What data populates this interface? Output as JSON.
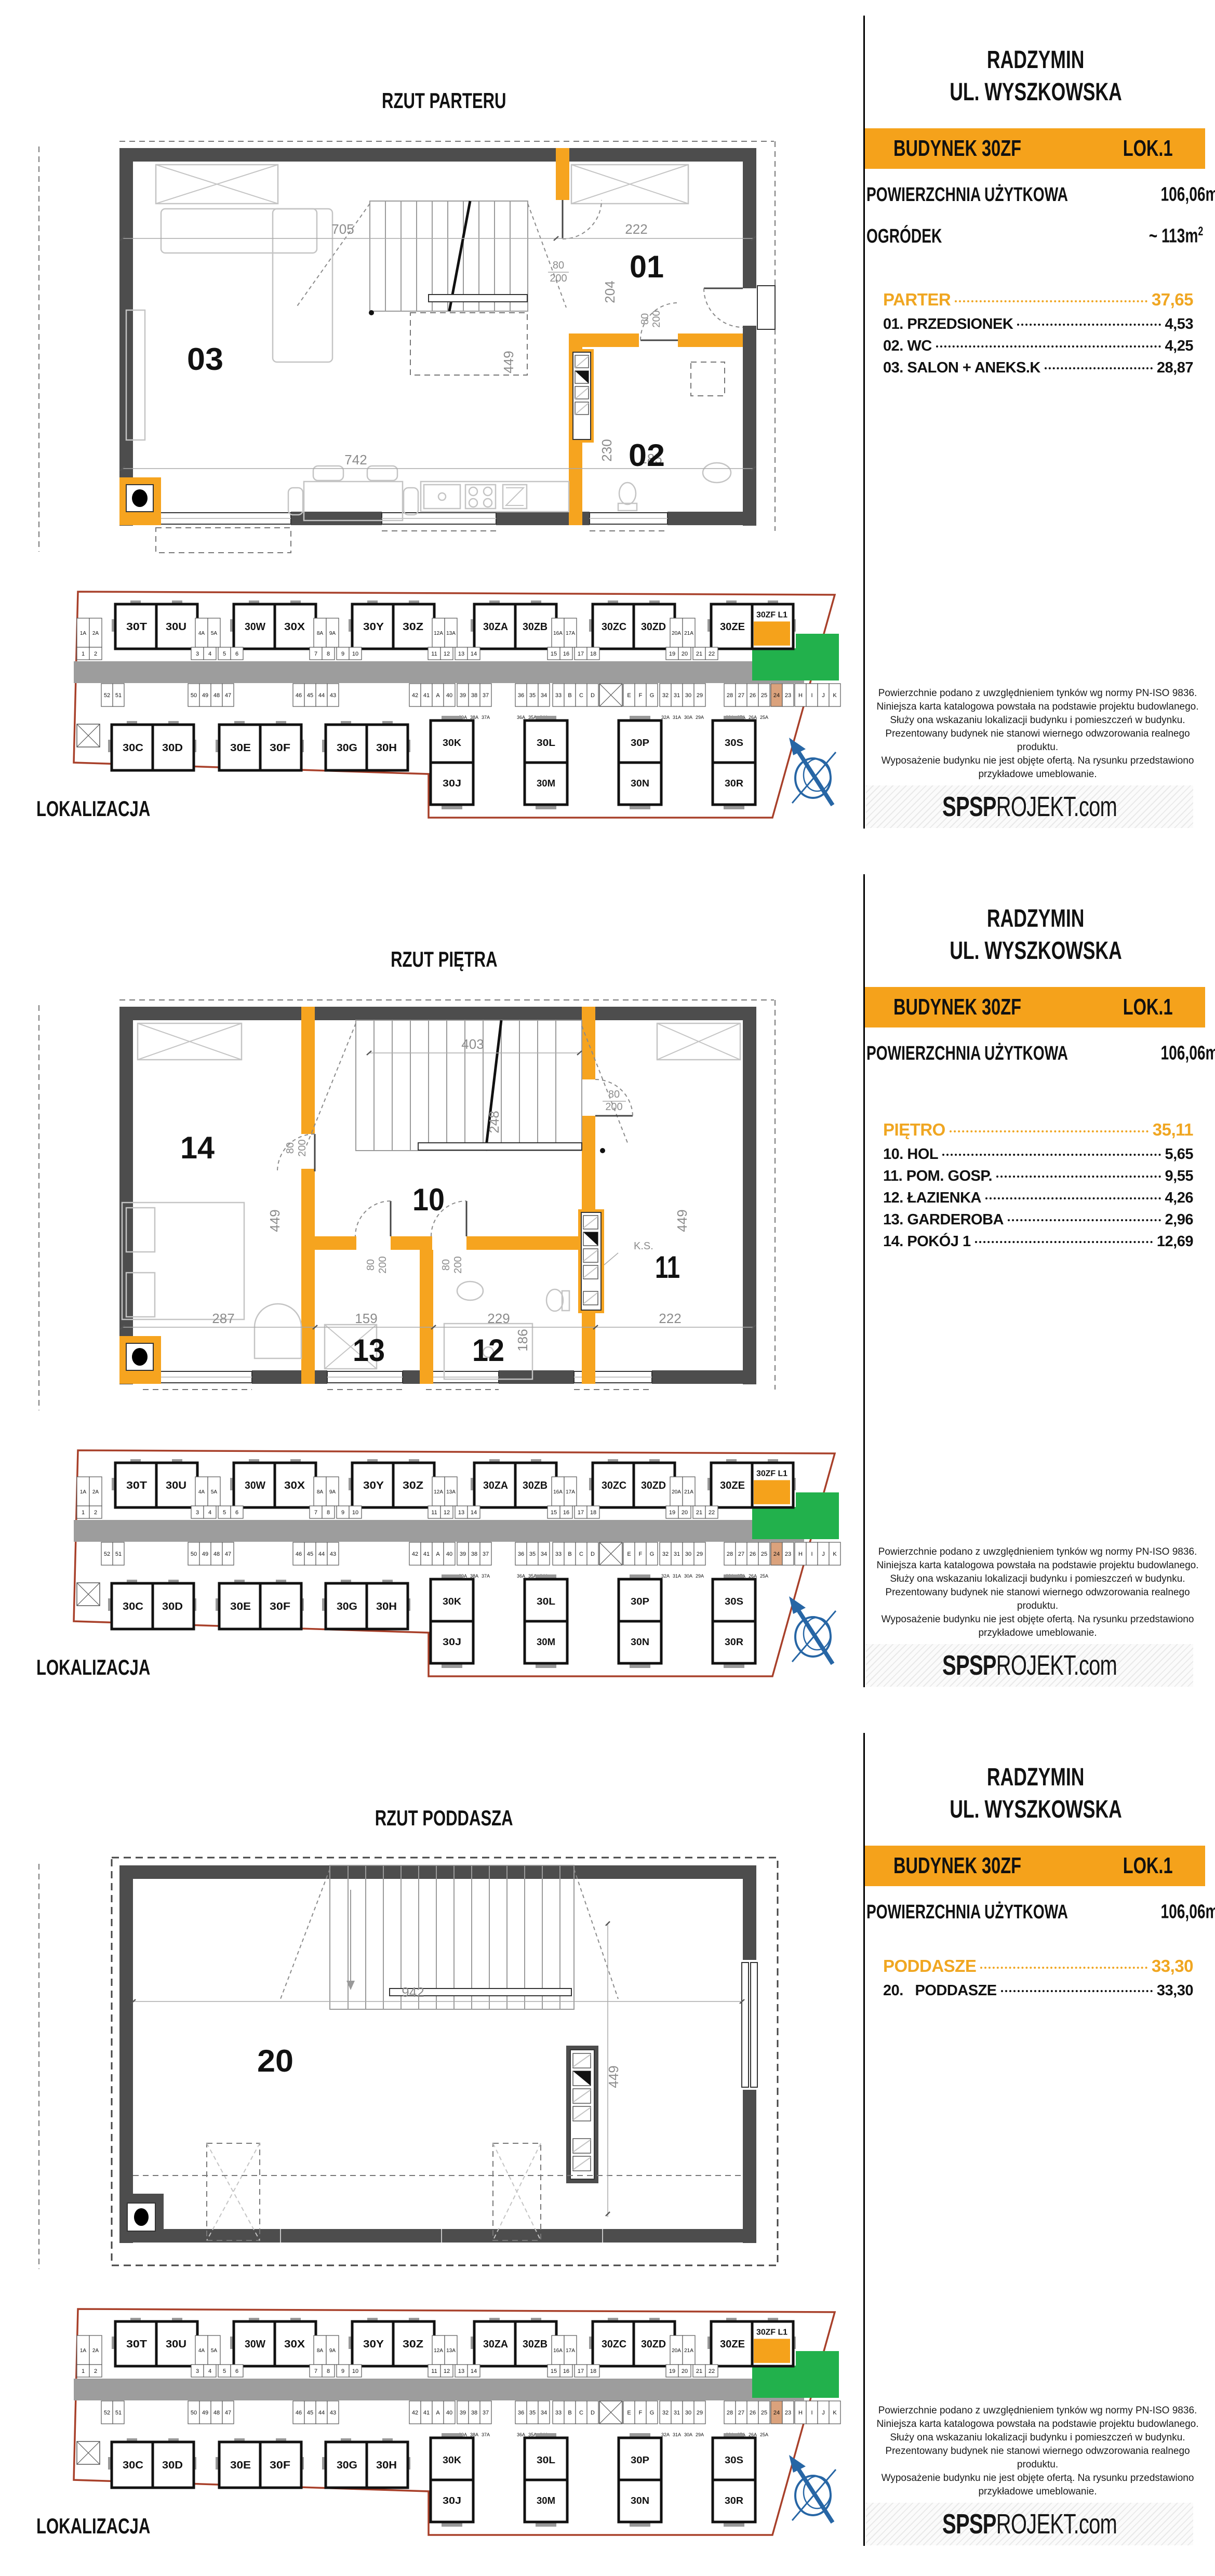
{
  "colors": {
    "accent": "#F5A21B",
    "plan_wall": "#4D4D4D",
    "plan_orange": "#F6A41F",
    "road": "#9D9D9D",
    "garden_green": "#22B14C",
    "boundary_red": "#A8402A",
    "compass_blue": "#2766A5",
    "stall_orange": "#DBA27C",
    "dim_gray": "#8C8C8C"
  },
  "shared": {
    "header": {
      "city": "RADZYMIN",
      "street": "UL. WYSZKOWSKA",
      "building": "BUDYNEK 30ZF",
      "unit": "LOK.1",
      "area_label": "POWIERZCHNIA UŻYTKOWA",
      "area_value": "106,06m",
      "area_sup": "2"
    },
    "disclaimer_lines": [
      "Powierzchnie podano z uwzględnieniem tynków wg normy PN-ISO 9836.",
      "Niniejsza karta katalogowa powstała na podstawie projektu budowlanego.",
      "Służy ona wskazaniu lokalizacji budynku i pomieszczeń w budynku.",
      "Prezentowany budynek nie stanowi wiernego odwzorowania realnego produktu.",
      "Wyposażenie budynku nie jest objęte ofertą. Na rysunku przedstawiono",
      "przykładowe umeblowanie."
    ],
    "logo": {
      "bold": "SPSP",
      "light": "ROJEKT",
      "suffix": ".com"
    },
    "map_label": "LOKALIZACJA",
    "map": {
      "top_pairs": [
        [
          "30T",
          "30U"
        ],
        [
          "30W",
          "30X"
        ],
        [
          "30Y",
          "30Z"
        ],
        [
          "30ZA",
          "30ZB"
        ],
        [
          "30ZC",
          "30ZD"
        ],
        [
          "30ZE",
          "30ZF L1"
        ]
      ],
      "bottom_pairs": [
        [
          "30C",
          "30D"
        ],
        [
          "30E",
          "30F"
        ],
        [
          "30G",
          "30H"
        ]
      ],
      "vertical_pairs": [
        [
          "30K",
          "30J"
        ],
        [
          "30L",
          "30M"
        ],
        [
          "30P",
          "30N"
        ],
        [
          "30S",
          "30R"
        ]
      ],
      "parking_upper": [
        "1A",
        "2A",
        "4A",
        "5A",
        "8A",
        "9A",
        "12A",
        "13A",
        "16A",
        "17A",
        "20A",
        "21A"
      ],
      "parking_lower": [
        "1",
        "2",
        "3",
        "4",
        "5",
        "6",
        "7",
        "8",
        "9",
        "10",
        "11",
        "12",
        "13",
        "14",
        "15",
        "16",
        "17",
        "18",
        "19",
        "20",
        "21",
        "22"
      ],
      "parking_mid": [
        "52",
        "51",
        "50",
        "49",
        "48",
        "47",
        "46",
        "45",
        "44",
        "43",
        "42",
        "41",
        "A",
        "40",
        "39",
        "38",
        "37",
        "36",
        "35",
        "34",
        "33",
        "B",
        "C",
        "D",
        "E",
        "F",
        "G",
        "32",
        "31",
        "30",
        "29",
        "28",
        "27",
        "26",
        "25",
        "24",
        "23",
        "H",
        "I",
        "J",
        "K"
      ],
      "parking_sub": [
        [
          "39A",
          "38A",
          "37A"
        ],
        [
          "36A",
          "35A",
          "34A"
        ],
        [
          "32A",
          "31A",
          "30A",
          "29A"
        ],
        [
          "28A",
          "27A",
          "26A",
          "25A"
        ]
      ],
      "highlight_label": "30ZF L1",
      "orange_stall": "24"
    }
  },
  "panels": [
    {
      "title": "RZUT PARTERU",
      "garden": {
        "label": "OGRÓDEK",
        "value": "~ 113m",
        "sup": "2"
      },
      "list": {
        "header": {
          "label": "PARTER",
          "value": "37,65"
        },
        "items": [
          {
            "label": "01. PRZEDSIONEK",
            "value": "4,53"
          },
          {
            "label": "02. WC",
            "value": "4,25"
          },
          {
            "label": "03. SALON + ANEKS.K",
            "value": "28,87"
          }
        ]
      },
      "plan": {
        "rooms": {
          "r01": "01",
          "r02": "02",
          "r03": "03"
        },
        "dims": {
          "d705": "705",
          "d222": "222",
          "d204": "204",
          "d449": "449",
          "d742": "742",
          "d230": "230",
          "d185": "185",
          "door_w": "80",
          "door_h": "200"
        }
      }
    },
    {
      "title": "RZUT PIĘTRA",
      "list": {
        "header": {
          "label": "PIĘTRO",
          "value": "35,11"
        },
        "items": [
          {
            "label": "10. HOL",
            "value": "5,65"
          },
          {
            "label": "11. POM. GOSP.",
            "value": "9,55"
          },
          {
            "label": "12. ŁAZIENKA",
            "value": "4,26"
          },
          {
            "label": "13. GARDEROBA",
            "value": "2,96"
          },
          {
            "label": "14. POKÓJ 1",
            "value": "12,69"
          }
        ]
      },
      "plan": {
        "rooms": {
          "r10": "10",
          "r11": "11",
          "r12": "12",
          "r13": "13",
          "r14": "14"
        },
        "dims": {
          "d403": "403",
          "d248": "248",
          "d449": "449",
          "d287": "287",
          "d159": "159",
          "d229": "229",
          "d186": "186",
          "d222": "222",
          "door_w": "80",
          "door_h": "200",
          "ks": "K.S."
        }
      }
    },
    {
      "title": "RZUT PODDASZA",
      "list": {
        "header": {
          "label": "PODDASZE",
          "value": "33,30"
        },
        "items": [
          {
            "label": "20.   PODDASZE",
            "value": "33,30"
          }
        ]
      },
      "plan": {
        "rooms": {
          "r20": "20"
        },
        "dims": {
          "d942": "942",
          "d449": "449"
        }
      }
    }
  ]
}
